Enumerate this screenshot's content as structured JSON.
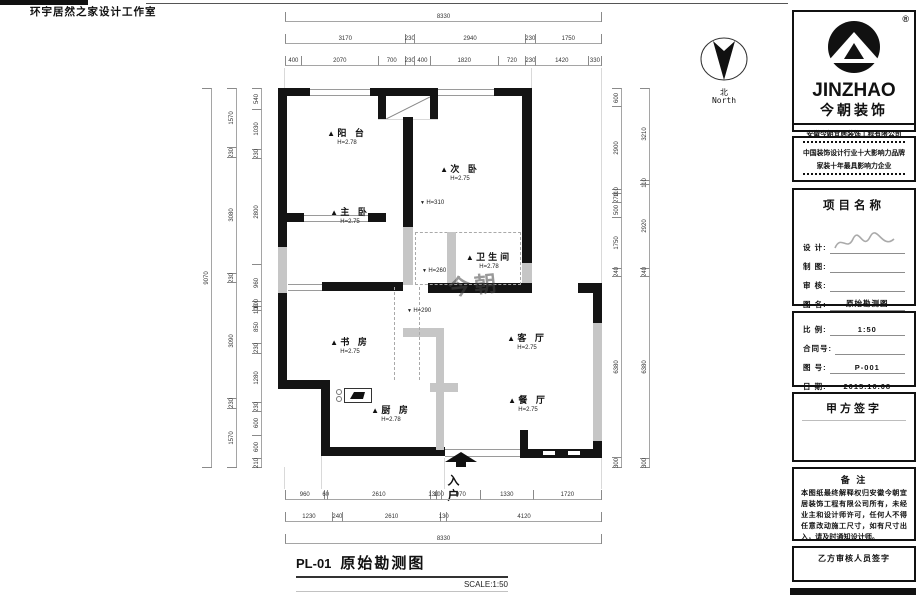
{
  "header": {
    "studio": "环宇居然之家设计工作室"
  },
  "north": {
    "cn": "北",
    "en": "North"
  },
  "plan": {
    "rooms": [
      {
        "name": "阳 台",
        "h": "H=2.78"
      },
      {
        "name": "次 卧",
        "h": "H=2.75"
      },
      {
        "name": "主 卧",
        "h": "H=2.75"
      },
      {
        "name": "卫生间",
        "h": "H=2.78"
      },
      {
        "name": "书 房",
        "h": "H=2.75"
      },
      {
        "name": "客 厅",
        "h": "H=2.75"
      },
      {
        "name": "餐 厅",
        "h": "H=2.75"
      },
      {
        "name": "厨 房",
        "h": "H=2.78"
      }
    ],
    "beams": [
      {
        "t": "H=310"
      },
      {
        "t": "H=260"
      },
      {
        "t": "H=290"
      }
    ],
    "entry": "入户",
    "watermark": "今朝"
  },
  "dims": {
    "top1": [
      8330
    ],
    "top2": [
      3170,
      230,
      2940,
      230,
      1750
    ],
    "top3": [
      400,
      2070,
      700,
      230,
      400,
      1820,
      720,
      230,
      1420,
      330
    ],
    "bottom1": [
      960,
      60,
      2610,
      130,
      100,
      970,
      1330,
      1720
    ],
    "bottom2": [
      1230,
      240,
      2610,
      130,
      4120
    ],
    "bottom3": [
      8330
    ],
    "left_outer": [
      9070
    ],
    "left_mid": [
      1570,
      230,
      3080,
      230,
      3090,
      230,
      1570
    ],
    "left_inner": [
      540,
      1030,
      230,
      2800,
      960,
      100,
      100,
      850,
      230,
      1280,
      230,
      600,
      600,
      210
    ],
    "right_inner": [
      600,
      2900,
      110,
      270,
      500,
      1750,
      240,
      6380,
      300
    ],
    "right_outer": [
      3210,
      110,
      2920,
      240,
      6380,
      300
    ]
  },
  "titleblock": {
    "reg": "®",
    "logo_en": "JINZHAO",
    "logo_cn": "今朝装饰",
    "company": "安徽今朝宜居装饰工程有限公司",
    "award1": "中国装饰设计行业十大影响力品牌",
    "award2": "家装十年最具影响力企业",
    "project_title": "项目名称",
    "fields": [
      {
        "label": "设 计:",
        "value": ""
      },
      {
        "label": "制 图:",
        "value": ""
      },
      {
        "label": "审 核:",
        "value": ""
      },
      {
        "label": "图 名:",
        "value": "原始勘测图"
      }
    ],
    "fields2": [
      {
        "label": "比 例:",
        "value": "1:50"
      },
      {
        "label": "合同号:",
        "value": ""
      },
      {
        "label": "图 号:",
        "value": "P-001"
      },
      {
        "label": "日 期:",
        "value": "2015.10.08"
      }
    ],
    "sign_a": "甲方签字",
    "notes_title": "备 注",
    "notes": "本图纸最终解释权归安徽今朝宜居装饰工程有限公司所有，未经业主和设计师许可，任何人不得任意改动施工尺寸，如有尺寸出入，请及时通知设计师。",
    "sign_b": "乙方审核人员签字"
  },
  "footer": {
    "sheet_no": "PL-01",
    "title": "原始勘测图",
    "scale": "SCALE:1:50"
  }
}
